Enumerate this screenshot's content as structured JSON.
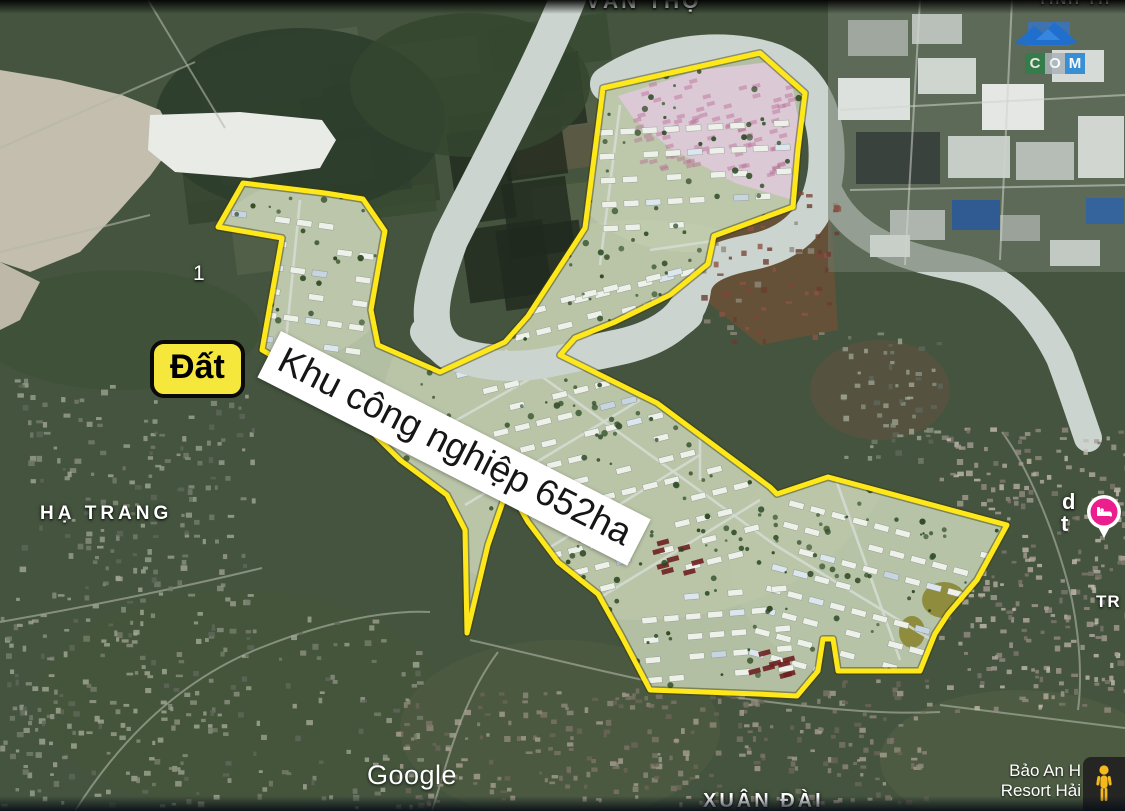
{
  "overlay": {
    "zone_name": "Khu công nghiệp 652ha",
    "land_tag": "Đất",
    "outline_color": "#ffe81a",
    "tag_bg": "#f6e73c"
  },
  "place_labels": {
    "top_commune": "VĂN THỌ",
    "top_right_partial": "TỈNH TH",
    "west_village": "HẠ TRANG",
    "south_village": "XUÂN ĐÀI",
    "road_marker": "1",
    "east_partial_line1": "d",
    "east_partial_line2": "t",
    "east_edge_partial": "TR"
  },
  "poi": {
    "resort_name_line1": "Bảo An H",
    "resort_name_line2": "Resort Hải",
    "lodging_pin_color": "#ea1e8c"
  },
  "watermark": {
    "letter_c": "C",
    "letter_o": "O",
    "letter_m": "M",
    "c_bg": "#2e8049",
    "o_bg": "#a9b2b8",
    "m_bg": "#1e82d4",
    "roof_color": "#1f6fd0"
  },
  "attribution": {
    "logo": "Google"
  },
  "controls": {
    "pegman_color": "#f5b91e"
  }
}
